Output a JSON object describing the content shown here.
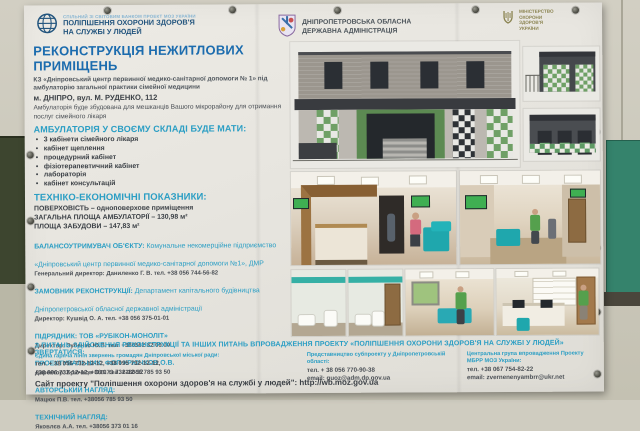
{
  "header": {
    "worldbank": {
      "icon": "globe-icon",
      "small_line": "СПІЛЬНИЙ ЗІ СВІТОВИМ БАНКОМ ПРОЕКТ МОЗ УКРАЇНИ",
      "line1": "ПОЛІПШЕННЯ ОХОРОНИ ЗДОРОВ'Я",
      "line2": "НА СЛУЖБІ У ЛЮДЕЙ"
    },
    "oda": {
      "icon": "coat-of-arms-icon",
      "line1": "ДНІПРОПЕТРОВСЬКА ОБЛАСНА",
      "line2": "ДЕРЖАВНА АДМІНІСТРАЦІЯ"
    },
    "moz": {
      "icon": "trident-icon",
      "line1": "МІНІСТЕРСТВО",
      "line2": "ОХОРОНИ",
      "line3": "ЗДОРОВ'Я",
      "line4": "УКРАЇНИ"
    }
  },
  "title": "РЕКОНСТРУКЦІЯ НЕЖИТЛОВИХ ПРИМІЩЕНЬ",
  "subtitle": "КЗ «Дніпровський центр первинної медико-санітарної допомоги № 1» під амбулаторію загальної практики сімейної медицини",
  "address": "м. ДНІПРО, вул. М. РУДЕНКО, 112",
  "intro": "Амбулаторія буде збудована для мешканців Вашого мікрорайону для отримання послуг сімейного лікаря",
  "composition": {
    "heading": "АМБУЛАТОРІЯ У СВОЄМУ СКЛАДІ БУДЕ МАТИ:",
    "items": [
      "3 кабінети сімейного лікаря",
      "кабінет щеплення",
      "процедурний кабінет",
      "фізіотерапевтичний кабінет",
      "лабораторія",
      "кабінет консультацій"
    ]
  },
  "indicators": {
    "heading": "ТЕХНІКО-ЕКОНОМІЧНІ ПОКАЗНИКИ:",
    "lines": [
      "ПОВЕРХОВІСТЬ – одноповерхове приміщення",
      "ЗАГАЛЬНА ПЛОЩА АМБУЛАТОРІЇ – 130,98 м²",
      "ПЛОЩА ЗАБУДОВИ – 147,83 м²"
    ]
  },
  "parties": [
    {
      "label": "БАЛАНСОУТРИМУВАЧ ОБ'ЄКТУ:",
      "text": " Комунальне некомерційне підприємство «Дніпровський центр первинної медико-санітарної допомоги №1», ДМР",
      "contact": "Генеральний директор: Даниленко Г. В.   тел. +38 056 744-56-82"
    },
    {
      "label": "ЗАМОВНИК РЕКОНСТРУКЦІЇ:",
      "text": " Департамент капітального будівництва Дніпропетровської обласної державної адміністрації",
      "contact": "Директор: Кушвід О. А.   тел. +38 056 375-01-01"
    },
    {
      "label": "ПІДРЯДНИК: ТОВ «РУБІКОН-МОНОЛІТ»",
      "text": "",
      "contact": "Директор: Зубенко Ю.В. тел. +380562 32 00 00"
    },
    {
      "label": "ПРОЕКТУВАЛЬНИК: ФОП КРЮЧКОВ О.В.",
      "text": "",
      "contact": "Директор: Крючков О.В. тел. +38056 785 93 50"
    },
    {
      "label": "АВТОРСЬКИЙ НАГЛЯД:",
      "text": "",
      "contact": "Мацюк П.В. тел. +38056 785 93 50"
    },
    {
      "label": "ТЕХНІЧНИЙ НАГЛЯД:",
      "text": "",
      "contact": "Яковлєв А.А. тел. +38056 373 01 16"
    }
  ],
  "appeal_heading": "З ПИТАНЬ ЗДІЙСНЕННЯ РЕКОНСТРУКЦІЇ ТА ІНШИХ ПИТАНЬ ВПРОВАДЖЕННЯ ПРОЕКТУ «ПОЛІПШЕННЯ ОХОРОНИ ЗДОРОВ'Я НА СЛУЖБІ У ЛЮДЕЙ» ЗВЕРТАТИСЯ:",
  "contacts": [
    {
      "heading": "Єдина гаряча лінія звернень громадян Дніпровської міської ради:",
      "line1": "тел. + 38 056 732-12-12, +38 095 732-12-12,",
      "line2": "+38 096 732-12-12, +38 073 732-12-12"
    },
    {
      "heading": "Представництво субпроекту у Дніпропетровській області:",
      "line1": "тел. + 38 056 770-90-38",
      "line2": "email: guoz@adm.dp.gov.ua"
    },
    {
      "heading": "Центральна група впровадження Проекту МБРР МОЗ України:",
      "line1": "тел. +38 067 754-82-22",
      "line2": "email: zvernenenyambrr@ukr.net"
    }
  ],
  "website": "Сайт проекту \"Поліпшення охорони здоров'я на службі у людей\":  http://wb.moz.gov.ua",
  "images": {
    "front_elevation": "building-front-elevation-drawing",
    "side_elevation_1": "building-side-elevation-drawing",
    "side_elevation_2": "building-rear-elevation-drawing",
    "render_reception": "interior-render-reception",
    "render_corridor": "interior-render-corridor",
    "render_bathroom_1": "interior-render-bathroom-1",
    "render_bathroom_2": "interior-render-bathroom-2",
    "render_exam_room": "interior-render-exam-room",
    "render_office": "interior-render-office"
  },
  "colors": {
    "title_blue": "#1c6cae",
    "heading_teal": "#2b9ec4",
    "text_dark": "#3b4046",
    "wall_green": "#3d452f",
    "wall_teal": "#35836c",
    "accent_green": "#6fa066",
    "accent_teal_furniture": "#1fa7ad"
  }
}
